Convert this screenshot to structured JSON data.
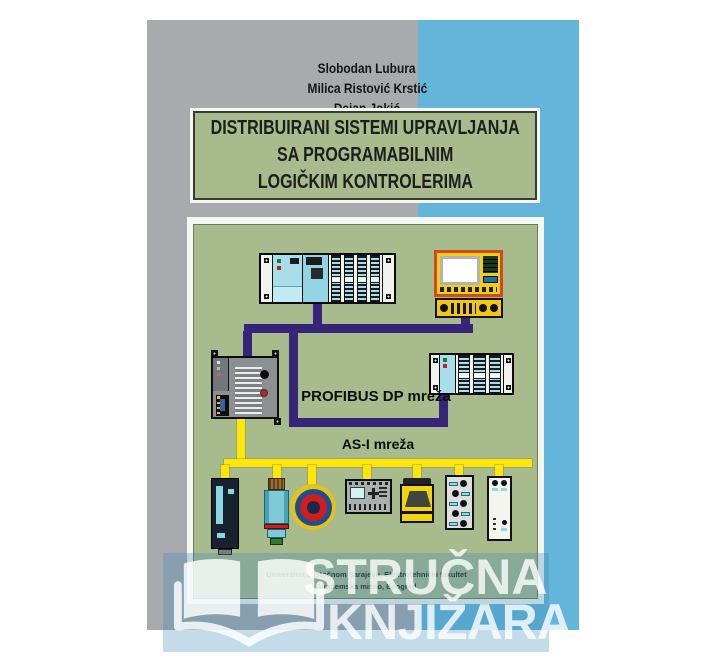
{
  "cover": {
    "authors": [
      "Slobodan Lubura",
      "Milica Ristović Krstić",
      "Dejan Jokić"
    ],
    "title_lines": [
      "DISTRIBUIRANI SISTEMI UPRAVLJANJA",
      "SA PROGRAMABILNIM",
      "LOGIČKIM KONTROLERIMA"
    ],
    "publisher": {
      "line1": "Univerzitet u Istočnom Sarajevu, Elektrotehnički fakultet",
      "line2": "Akademska misao, Beograd"
    },
    "colors": {
      "gray_panel": "#a8aaad",
      "blue_panel": "#63b6da",
      "green_box": "#a8bb8c",
      "profibus_purple": "#362478",
      "asi_yellow": "#ffe60a"
    }
  },
  "diagram": {
    "labels": {
      "profibus": "PROFIBUS DP mreža",
      "asi": "AS-I mreža"
    },
    "devices": [
      {
        "icon": "plc-rack-master-icon"
      },
      {
        "icon": "hmi-operator-panel-icon"
      },
      {
        "icon": "hmi-keypad-icon"
      },
      {
        "icon": "compact-plc-icon"
      },
      {
        "icon": "remote-io-rack-icon"
      },
      {
        "icon": "servo-drive-icon"
      },
      {
        "icon": "proximity-sensor-icon"
      },
      {
        "icon": "emergency-stop-button-icon"
      },
      {
        "icon": "logic-module-icon"
      },
      {
        "icon": "light-sensor-unit-icon"
      },
      {
        "icon": "asi-io-module-icon"
      },
      {
        "icon": "valve-terminal-icon"
      }
    ]
  },
  "watermark": {
    "line1": "STRUČNA",
    "line2": "KNJIŽARA",
    "icon": "open-book-icon"
  }
}
